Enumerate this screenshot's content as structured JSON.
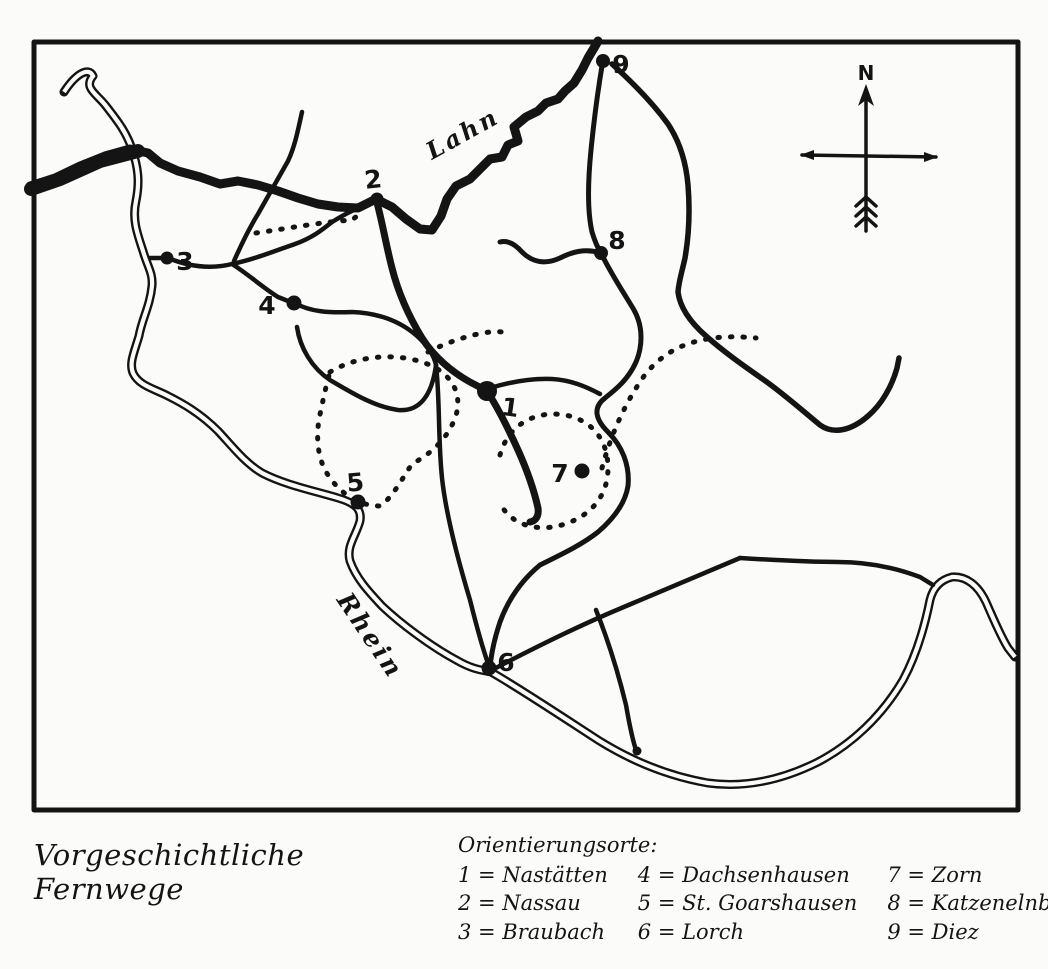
{
  "title": "Vorgeschichtliche Fernwege",
  "legend": {
    "heading": "Orientierungsorte:",
    "entries": [
      "1 = Nastätten",
      "2 = Nassau",
      "3 = Braubach",
      "4 = Dachsenhausen",
      "5 = St. Goarshausen",
      "6 = Lorch",
      "7 = Zorn",
      "8 = Katzenelnbogen",
      "9 = Diez"
    ]
  },
  "map": {
    "compass_label": "N",
    "rivers": {
      "lahn": "Lahn",
      "rhein": "Rhein"
    },
    "markers": [
      {
        "num": "1",
        "name": "Nastätten"
      },
      {
        "num": "2",
        "name": "Nassau"
      },
      {
        "num": "3",
        "name": "Braubach"
      },
      {
        "num": "4",
        "name": "Dachsenhausen"
      },
      {
        "num": "5",
        "name": "St. Goarshausen"
      },
      {
        "num": "6",
        "name": "Lorch"
      },
      {
        "num": "7",
        "name": "Zorn"
      },
      {
        "num": "8",
        "name": "Katzenelnbogen"
      },
      {
        "num": "9",
        "name": "Diez"
      }
    ]
  },
  "colors": {
    "ink": "#141414",
    "paper": "#fbfbf9"
  }
}
